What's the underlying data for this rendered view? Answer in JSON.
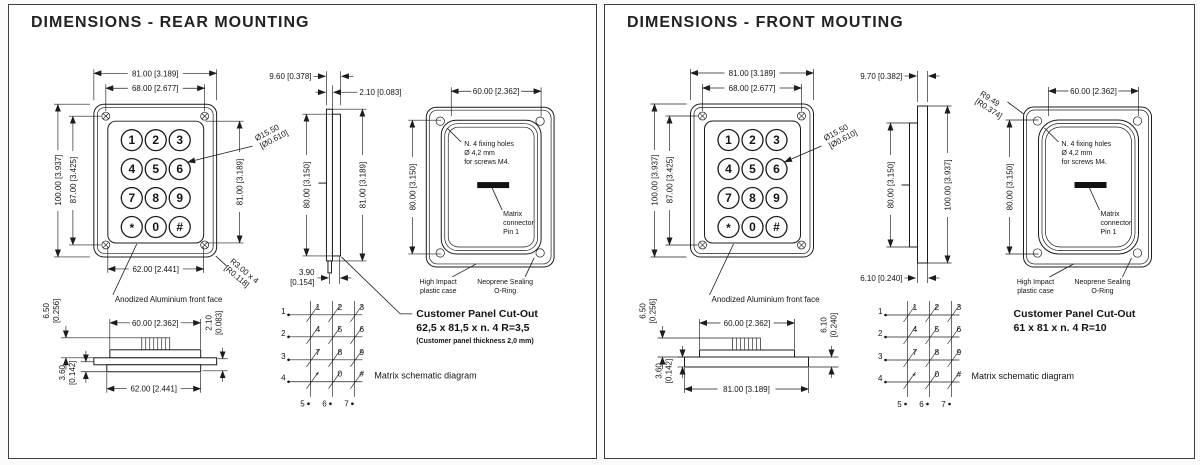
{
  "colors": {
    "ink": "#1c1c1c",
    "paper": "#ffffff"
  },
  "panels": [
    {
      "variant": "rear",
      "title": "DIMENSIONS - REAR MOUNTING",
      "keypad_keys": [
        "1",
        "2",
        "3",
        "4",
        "5",
        "6",
        "7",
        "8",
        "9",
        "*",
        "0",
        "#"
      ],
      "front_view": {
        "width": "81.00 [3.189]",
        "width_holes": "68.00 [2.677]",
        "height": "100.00 [3.937]",
        "height_holes": "87.00 [3.425]",
        "height_keypad": "81.00 [3.189]",
        "width_keypad": "62.00 [2.441]",
        "diameter_a": "Ø15.50",
        "diameter_b": "[Ø0.610]",
        "corner_radius_a": "R3.00 x 4",
        "corner_radius_b": "[R0.118]",
        "face_label": "Anodized Aluminium front face"
      },
      "side_view": {
        "top": "9.60 [0.378]",
        "flange": "2.10 [0.083]",
        "left": "80.00 [3.150]",
        "right": "81.00 [3.189]",
        "bottom_a": "3.90",
        "bottom_b": "[0.154]"
      },
      "rear_view": {
        "width": "60.00 [2.362]",
        "height": "80.00 [3.150]",
        "fixing_1": "N. 4 fixing holes",
        "fixing_2": "Ø 4,2 mm",
        "fixing_3": "for screws M4.",
        "connector_1": "Matrix",
        "connector_2": "connector",
        "connector_3": "Pin 1",
        "case_1": "High Impact",
        "case_2": "plastic case",
        "seal_1": "Neoprene Sealing",
        "seal_2": "O-Ring"
      },
      "bottom_view": {
        "height_a": "6.50",
        "height_b": "[0.256]",
        "width_top": "60.00 [2.362]",
        "thickness_a": "2.10",
        "thickness_b": "[0.083]",
        "depth_a": "3.60",
        "depth_b": "[0.142]",
        "width_bottom": "62.00 [2.441]"
      },
      "cutout": {
        "title": "Customer Panel Cut-Out",
        "size": "62,5 x 81,5 x n. 4  R=3,5",
        "note": "(Customer panel thickness 2,0 mm)"
      },
      "matrix": {
        "caption": "Matrix schematic diagram",
        "row_labels": [
          "1",
          "2",
          "3",
          "4"
        ],
        "col_labels": [
          "5",
          "6",
          "7"
        ],
        "cells": [
          "1",
          "2",
          "3",
          "4",
          "5",
          "6",
          "7",
          "8",
          "9",
          "*",
          "0",
          "#"
        ]
      }
    },
    {
      "variant": "front",
      "title": "DIMENSIONS - FRONT MOUTING",
      "keypad_keys": [
        "1",
        "2",
        "3",
        "4",
        "5",
        "6",
        "7",
        "8",
        "9",
        "*",
        "0",
        "#"
      ],
      "front_view": {
        "width": "81.00 [3.189]",
        "width_holes": "68.00 [2.677]",
        "height": "100.00 [3.937]",
        "height_holes": "87.00 [3.425]",
        "diameter_a": "Ø15.50",
        "diameter_b": "[Ø0.610]",
        "corner_radius_a": "R9.49",
        "corner_radius_b": "[R0.374]",
        "face_label": "Anodized Aluminium front face"
      },
      "side_view": {
        "top": "9.70 [0.382]",
        "left": "80.00 [3.150]",
        "right": "100.00 [3.937]",
        "bottom": "6.10 [0.240]"
      },
      "rear_view": {
        "width": "60.00 [2.362]",
        "height": "80.00 [3.150]",
        "fixing_1": "N. 4 fixing holes",
        "fixing_2": "Ø 4,2 mm",
        "fixing_3": "for screws M4.",
        "connector_1": "Matrix",
        "connector_2": "connector",
        "connector_3": "Pin 1",
        "case_1": "High Impact",
        "case_2": "plastic case",
        "seal_1": "Neoprene Sealing",
        "seal_2": "O-Ring"
      },
      "bottom_view": {
        "height_a": "6.50",
        "height_b": "[0.256]",
        "width_top": "60.00 [2.362]",
        "thickness_a": "6.10",
        "thickness_b": "[0.240]",
        "depth_a": "3.60",
        "depth_b": "[0.142]",
        "width_bottom": "81.00 [3.189]"
      },
      "cutout": {
        "title": "Customer Panel Cut-Out",
        "size": "61 x 81 x n. 4  R=10"
      },
      "matrix": {
        "caption": "Matrix schematic diagram",
        "row_labels": [
          "1",
          "2",
          "3",
          "4"
        ],
        "col_labels": [
          "5",
          "6",
          "7"
        ],
        "cells": [
          "1",
          "2",
          "3",
          "4",
          "5",
          "6",
          "7",
          "8",
          "9",
          "*",
          "0",
          "#"
        ]
      }
    }
  ]
}
